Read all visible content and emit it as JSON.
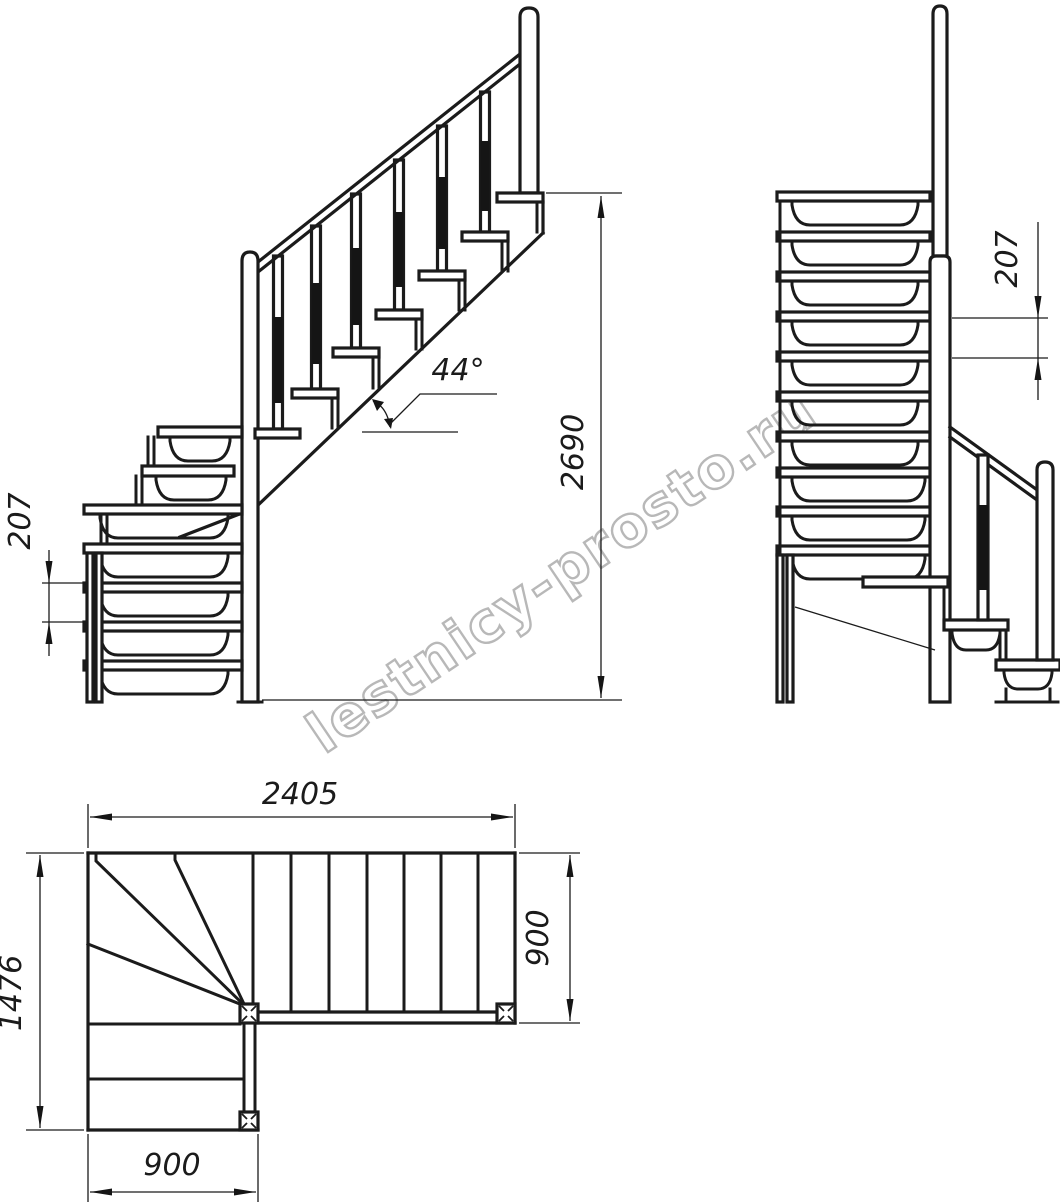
{
  "drawing": {
    "kind": "staircase technical drawing, three orthographic views",
    "line_color": "#1b1b1b",
    "background": "#ffffff"
  },
  "watermark": {
    "text": "lestnicy-prosto.ru",
    "color": "#b5b5b5"
  },
  "views": {
    "side": {
      "riser_height": "207",
      "stair_angle": "44°",
      "total_height": "2690"
    },
    "front": {
      "riser_height": "207"
    },
    "plan": {
      "total_length": "2405",
      "flight_width": "900",
      "total_depth": "1476",
      "lower_flight_width": "900"
    }
  }
}
